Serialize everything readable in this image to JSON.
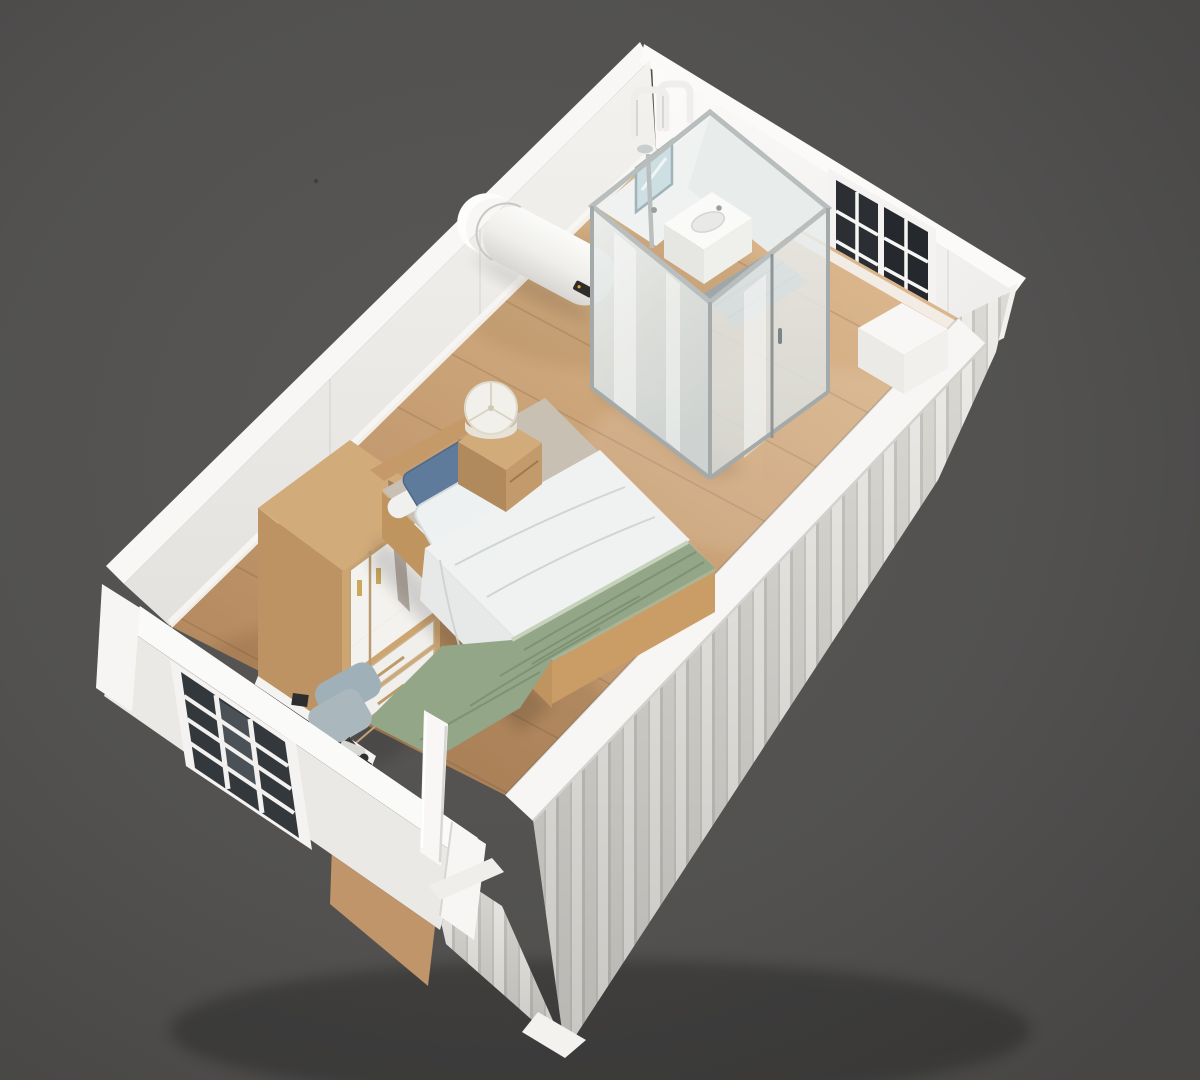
{
  "meta": {
    "subject": "Isometric 3D cutaway render of a white container tiny-house bedroom with glass bathroom pod",
    "canvas": {
      "width": 1200,
      "height": 1080
    }
  },
  "palette": {
    "background": "#525150",
    "background_edge": "#484746",
    "exterior_white": "#f6f5f3",
    "corrugation_light": "#eeede9",
    "corrugation_shade": "#d9d7d2",
    "corrugation_groove": "#c7c5c0",
    "interior_wall": "#efeeec",
    "interior_wall_bright": "#fbfaf9",
    "floor_wood_light": "#dcb88e",
    "floor_wood_mid": "#c9a176",
    "floor_wood_dark": "#b4895f",
    "glass_frost": "#e2e6e5",
    "aluminum_frame": "#a4a9a9",
    "tile_gray": "#a0a7ab",
    "furniture_wood": "#cda571",
    "furniture_wood_dark": "#b98f62",
    "mattress_taupe": "#c8c0b3",
    "duvet_white": "#f0f2f1",
    "blanket_green": "#93a688",
    "blanket_green_dark": "#7b9070",
    "pillow_blue": "#5e7b9b",
    "pillow_white": "#eef1f2",
    "chair_gray": "#a9b6bd",
    "desk_top_black": "#1a1a1a",
    "window_glass_dark": "#2b2f33",
    "heater_display_dark": "#2e2d2b",
    "handle_gold": "#c9a85c"
  },
  "scene": {
    "objects": [
      {
        "id": "container-shell",
        "label": "white flat-pack container shell, cutaway front walls",
        "color": "#f6f5f3"
      },
      {
        "id": "corrugated-cladding",
        "label": "corrugated exterior siding",
        "color": "#e3e1dd"
      },
      {
        "id": "floor",
        "label": "light oak plank floor",
        "color": "#c9a176"
      },
      {
        "id": "bathroom-pod",
        "label": "frosted-glass bathroom pod with aluminum frame",
        "color": "#e2e6e5"
      },
      {
        "id": "sink",
        "label": "white wall-hung basin",
        "color": "#fafaf9"
      },
      {
        "id": "mirror",
        "label": "bathroom mirror",
        "color": "#cddfe3"
      },
      {
        "id": "shower",
        "label": "shower column and head",
        "color": "#b9bfbf"
      },
      {
        "id": "pipes",
        "label": "white service pipes over pod",
        "color": "#efeeec"
      },
      {
        "id": "water-heater",
        "label": "wall-mounted electric water heater",
        "color": "#f6f6f4"
      },
      {
        "id": "rear-windows",
        "label": "two dark sash windows with white muntin grid",
        "color": "#2b2f33"
      },
      {
        "id": "corner-bench",
        "label": "white corner bench box",
        "color": "#f7f6f4"
      },
      {
        "id": "bed",
        "label": "single bed, wood platform frame",
        "color": "#ca9c66"
      },
      {
        "id": "pillow-blue",
        "label": "blue pillow",
        "color": "#5e7b9b"
      },
      {
        "id": "pillow-white",
        "label": "white pillow",
        "color": "#eef1f2"
      },
      {
        "id": "duvet",
        "label": "white duvet",
        "color": "#f0f2f1"
      },
      {
        "id": "blanket",
        "label": "sage green throw blanket",
        "color": "#93a688"
      },
      {
        "id": "nightstand",
        "label": "wood nightstand",
        "color": "#cfa979"
      },
      {
        "id": "table-lamp",
        "label": "white drum table lamp",
        "color": "#f2f0ea"
      },
      {
        "id": "wardrobe",
        "label": "two-door wardrobe, wood carcass with white doors and two drawers",
        "color": "#cda571"
      },
      {
        "id": "desk",
        "label": "wall desk with dark top",
        "color": "#1a1a1a"
      },
      {
        "id": "office-chair",
        "label": "gray swivel chair",
        "color": "#a9b6bd"
      },
      {
        "id": "front-window",
        "label": "white gridded window in cutaway end wall",
        "color": "#33383c"
      },
      {
        "id": "door",
        "label": "white door standing open in doorway",
        "color": "#f8f7f5"
      }
    ]
  }
}
